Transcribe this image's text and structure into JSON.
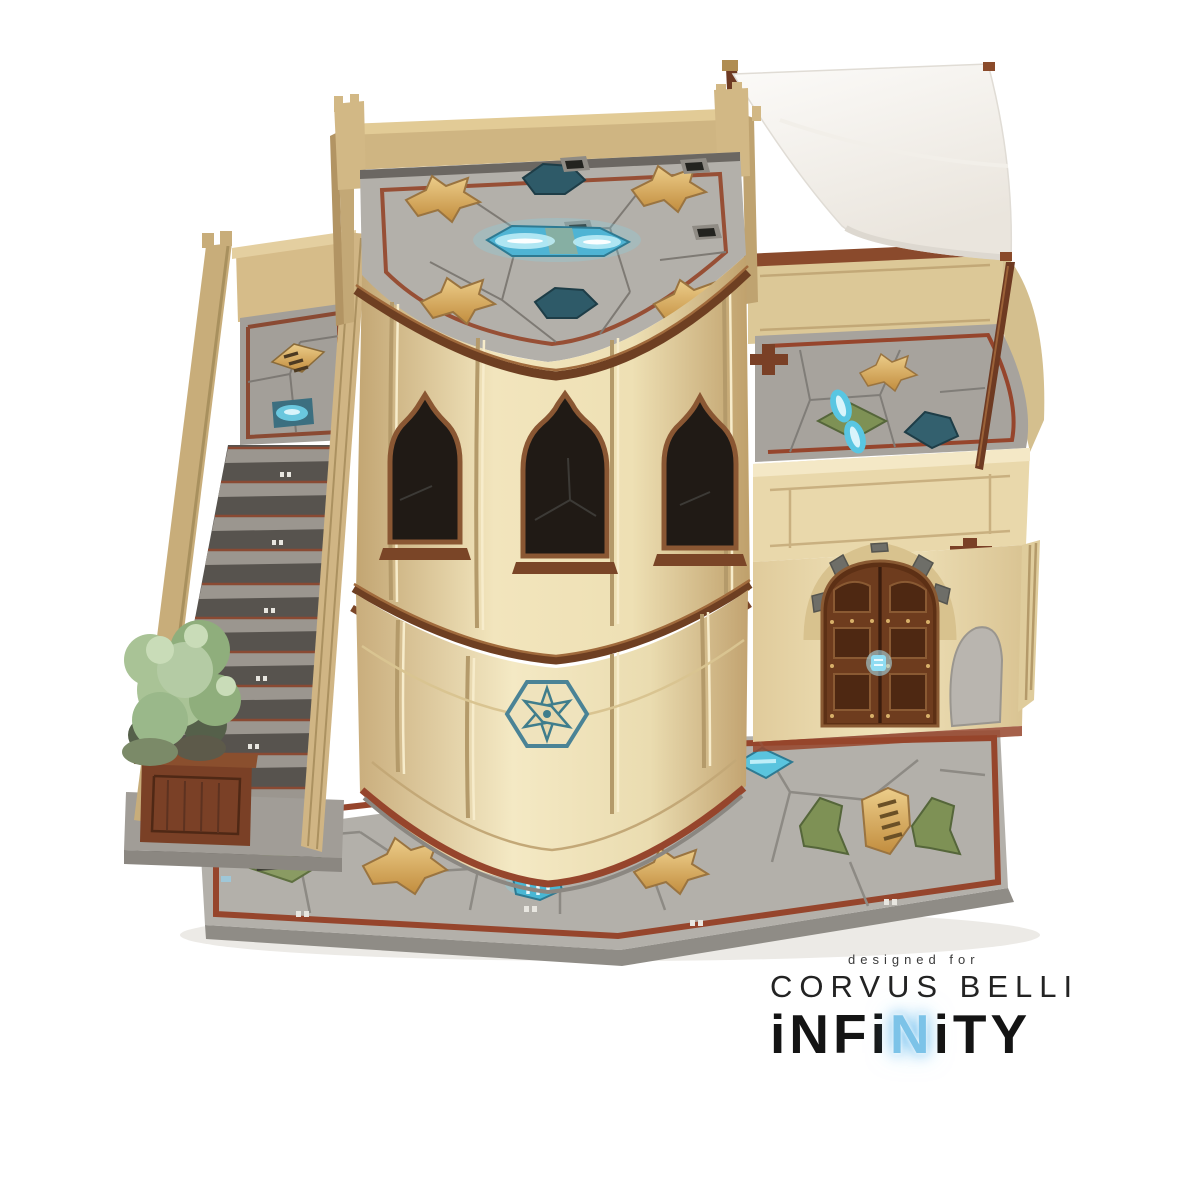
{
  "image": {
    "type": "product-photo",
    "subject": "laser-cut tabletop wargame terrain building: two-story rounded tower with tiled rooftop, side staircase, walled terrace with white awning, wooden double door and tiled plaza base",
    "background_color": "#ffffff"
  },
  "branding": {
    "designed_for": "designed for",
    "brand_name": "CORVUS BELLI",
    "logo": {
      "segments": [
        {
          "text": "iNFi"
        },
        {
          "text": "N",
          "accent": true
        },
        {
          "text": "iTY"
        }
      ],
      "accent_color": "#7cc3e8",
      "text_color": "#141414"
    }
  },
  "palette": {
    "wall_cream": "#eedeb6",
    "wall_shadow": "#c3a672",
    "parapet_tan": "#cfb582",
    "wood_brown": "#6e3a22",
    "wood_door": "#6e3c1e",
    "rust_red": "#96452c",
    "tile_gray": "#b3b0aa",
    "tile_gray_dark": "#8d8a84",
    "teal_dark": "#2e5a68",
    "glow_cyan": "#5fc6e2",
    "glow_core": "#d8f4fb",
    "gold_tile": "#d9a84e",
    "green_tile": "#7e9155",
    "plant_green": "#a9c396",
    "awning_white": "#f7f4ef"
  }
}
